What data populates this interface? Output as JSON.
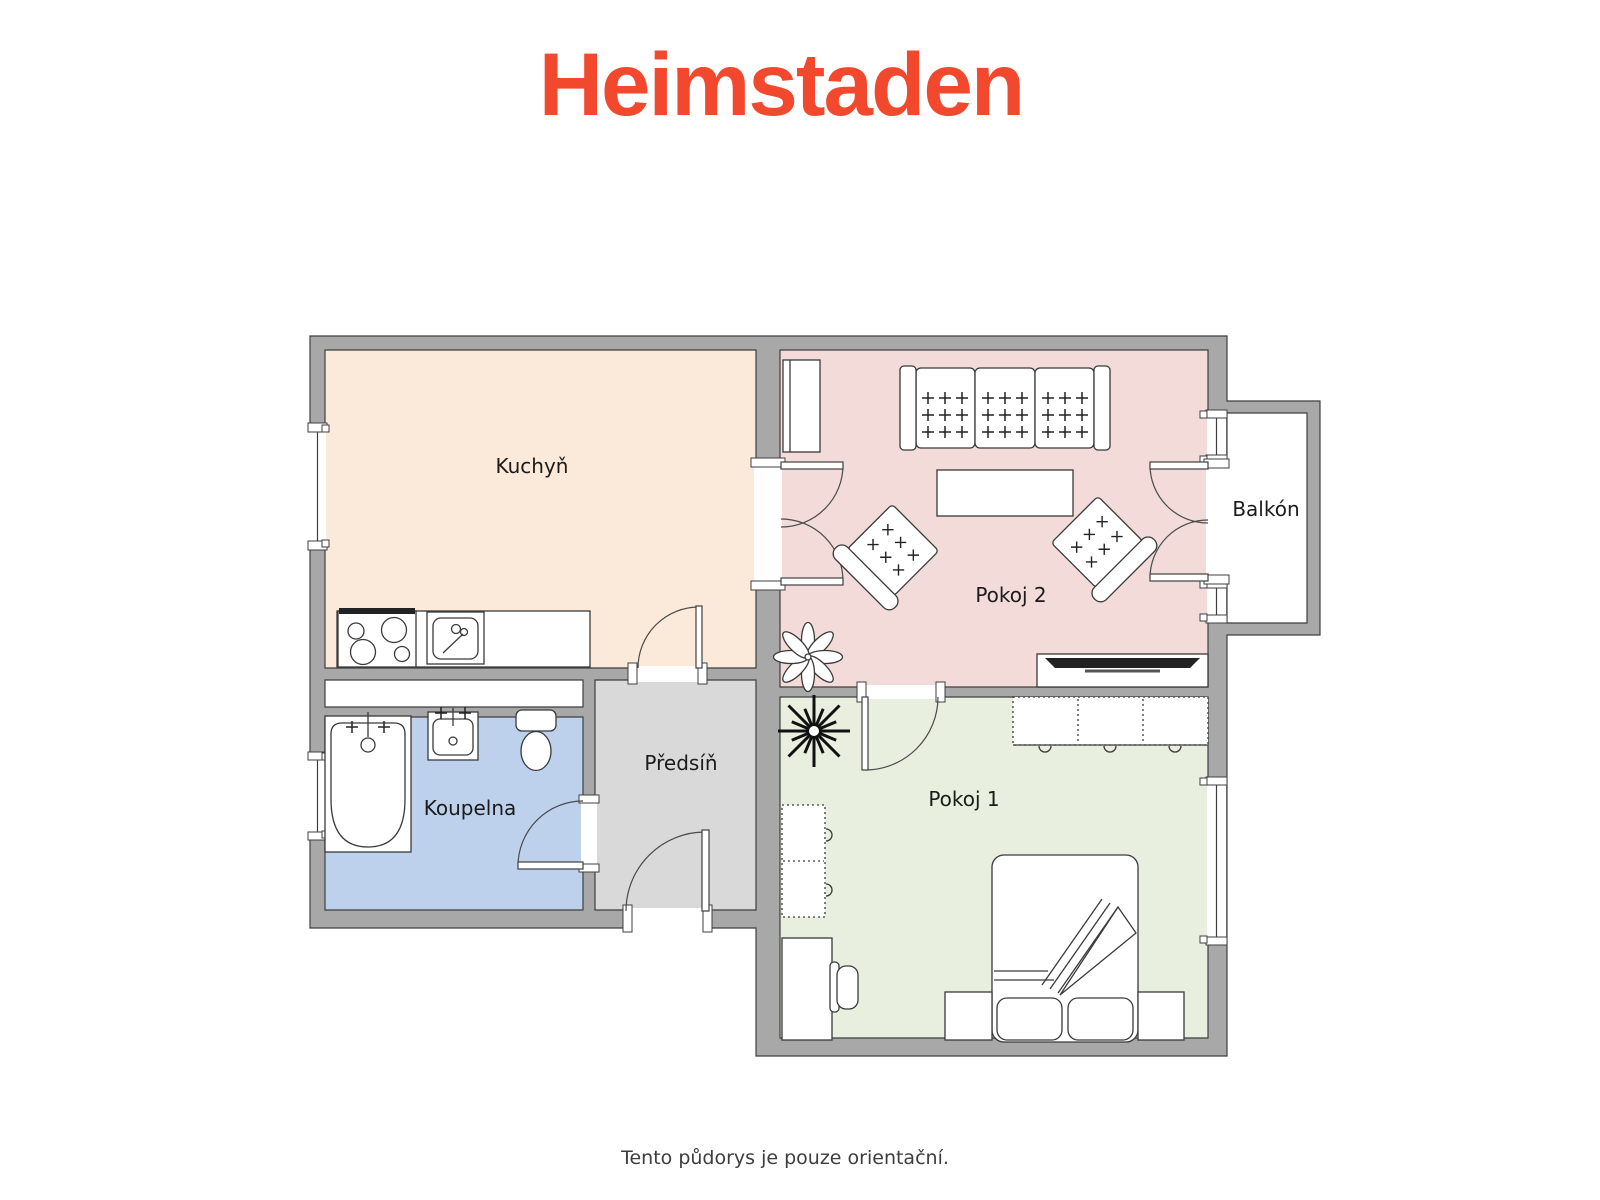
{
  "header": {
    "logo_text": "Heimstaden",
    "logo_color": "#F2492E"
  },
  "floorplan": {
    "wall_color": "#A8A8A8",
    "outline_color": "#3F3F3F",
    "rooms": [
      {
        "id": "kuchyn",
        "label": "Kuchyň",
        "floor_color": "#FBE9DA"
      },
      {
        "id": "pokoj2",
        "label": "Pokoj 2",
        "floor_color": "#F2DBD8"
      },
      {
        "id": "balkon",
        "label": "Balkón",
        "floor_color": "#FFFFFF"
      },
      {
        "id": "predsin",
        "label": "Předsíň",
        "floor_color": "#D9D9D9"
      },
      {
        "id": "koupelna",
        "label": "Koupelna",
        "floor_color": "#BDD1EC"
      },
      {
        "id": "pokoj1",
        "label": "Pokoj 1",
        "floor_color": "#E9EFDE"
      }
    ]
  },
  "footer": {
    "disclaimer": "Tento půdorys je pouze orientační."
  }
}
